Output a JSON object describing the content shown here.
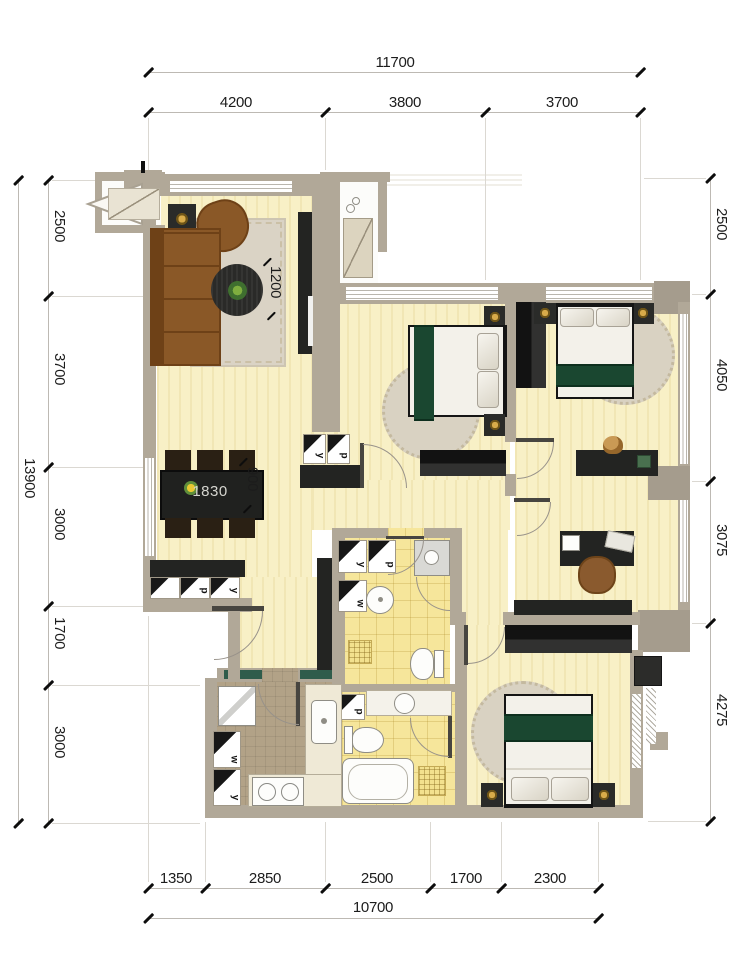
{
  "colors": {
    "wall": "#b1a898",
    "floor_yellow": "#f8f0c6",
    "bath_tile_yellow": "#f6e69b",
    "kitchen_floor_tan": "#b2a287",
    "dark_furniture": "#232422",
    "sofa_brown": "#8a5827",
    "bed_blanket_green": "#1a4730",
    "rug_beige": "#d9d2c2",
    "lamp_gold": "#d8ab4a",
    "kitchen_window_green": "#2f5c4b"
  },
  "dims": {
    "top": {
      "total": "11700",
      "segments": [
        "4200",
        "3800",
        "3700"
      ]
    },
    "bottom": {
      "total": "10700",
      "segments": [
        "1350",
        "2850",
        "2500",
        "1700",
        "2300"
      ]
    },
    "left": {
      "total": "13900",
      "segments": [
        "2500",
        "3700",
        "3000",
        "1700",
        "3000"
      ]
    },
    "right": {
      "segments": [
        "2500",
        "4050",
        "3075",
        "4275"
      ]
    },
    "interior": {
      "living_depth": "1200",
      "table_length": "1830",
      "table_width": "900"
    }
  },
  "cells": {
    "hall_closet": [
      "y",
      "p"
    ],
    "dining_sideboard": [
      "",
      "p",
      "y"
    ],
    "bath1": [
      "y",
      "p",
      "w"
    ],
    "bath2": [
      "p"
    ],
    "kitchen": [
      "w",
      "y"
    ]
  }
}
